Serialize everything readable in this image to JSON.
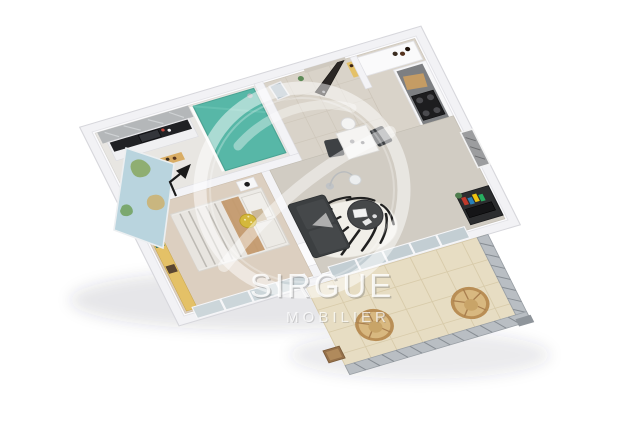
{
  "scene": {
    "type": "3d-floor-plan-render",
    "view": "isometric-top-down",
    "background_color": "#ffffff",
    "subject": "one-bedroom apartment with balcony terrace"
  },
  "watermark": {
    "brand": "SIRGUE",
    "tagline": "MOBILIER",
    "logo_shape": "translucent double circle with curved swoosh",
    "text_color": "#ffffff"
  },
  "rooms": [
    {
      "name": "bathroom",
      "position": "top-left",
      "features": [
        "teal walk-in shower",
        "vanity with black worktop and sink",
        "marble splashback",
        "wooden ladder towel rack",
        "blue towel",
        "small wood shelf"
      ]
    },
    {
      "name": "entry hall",
      "position": "top-center",
      "features": [
        "dark open front door",
        "seascape wall picture",
        "beige tiled floor"
      ]
    },
    {
      "name": "kitchen",
      "position": "top-right",
      "features": [
        "white cabinet run",
        "dark grey worktop",
        "black cooktop",
        "stainless sink",
        "wood cutting board",
        "tall white cabinet",
        "dark bottles"
      ]
    },
    {
      "name": "bedroom",
      "position": "left",
      "features": [
        "double bed with grey striped duvet",
        "white pillows",
        "mustard polka cushion",
        "tan throw",
        "white nightstand",
        "black desk lamp",
        "yellow wall shelf with books",
        "world map poster",
        "glazed south wall",
        "beige carpet"
      ]
    },
    {
      "name": "living room",
      "position": "center",
      "features": [
        "charcoal sofa",
        "zebra print rug",
        "round black coffee table with laptop",
        "arc floor lamp",
        "white dining table",
        "two dark dining chairs",
        "dark TV unit with colorful books",
        "black and white wall art",
        "glazed balcony doors"
      ]
    },
    {
      "name": "balcony",
      "position": "bottom-right",
      "features": [
        "beige tiled floor",
        "grey metal railing with diagonal balusters",
        "two rattan peacock chairs",
        "small wooden stool"
      ]
    }
  ],
  "palette": {
    "wall": "#f2f2f5",
    "floor_tile": "#d9d3c9",
    "bedroom_carpet": "#dccfc0",
    "living_floor": "#d1ccc3",
    "shower_teal": "#57b7a7",
    "sofa_charcoal": "#3c3f41",
    "shelf_yellow": "#e4c167",
    "rattan": "#b98e55",
    "balcony_tile": "#e7ddc3",
    "railing_grey": "#aab0b5",
    "front_door_dark": "#2b2725",
    "accent_yellow": "#d4b83c"
  }
}
